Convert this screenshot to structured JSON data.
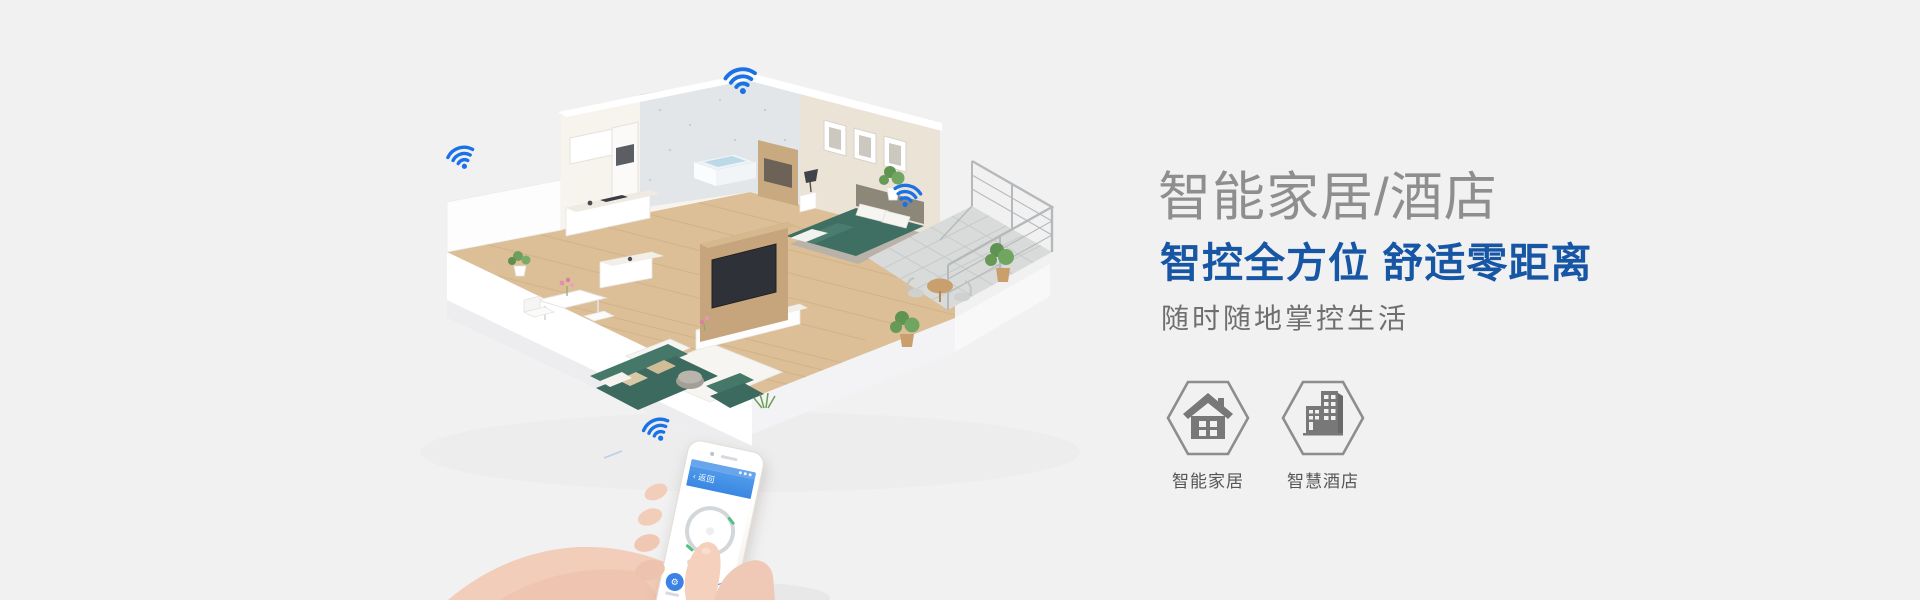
{
  "page": {
    "kind": "smart-home-banner"
  },
  "headline": {
    "title": "智能家居/酒店",
    "subtitle": "智控全方位 舒适零距离",
    "tagline": "随时随地掌控生活"
  },
  "features": [
    {
      "label": "智能家居",
      "icon": "house-icon"
    },
    {
      "label": "智慧酒店",
      "icon": "building-icon"
    }
  ],
  "phone": {
    "back_chevron": "‹",
    "back_label": "返回",
    "icons": {
      "power": "⚙",
      "light": "☼",
      "settings": "⚙"
    }
  },
  "scene": {
    "wifi_icon": "wifi-arcs-with-dot",
    "wifi_count": 4,
    "illustration": "isometric-apartment-cutaway"
  },
  "colors": {
    "background": "#f1f1f2",
    "wifi_blue": "#1b72e6",
    "headline_blue": "#1656a4",
    "title_gray": "#8e8e8e",
    "phone_header_blue": "#418ee6",
    "sofa_teal": "#3f6e61",
    "hex_stroke_gray": "#8d8d8d"
  }
}
